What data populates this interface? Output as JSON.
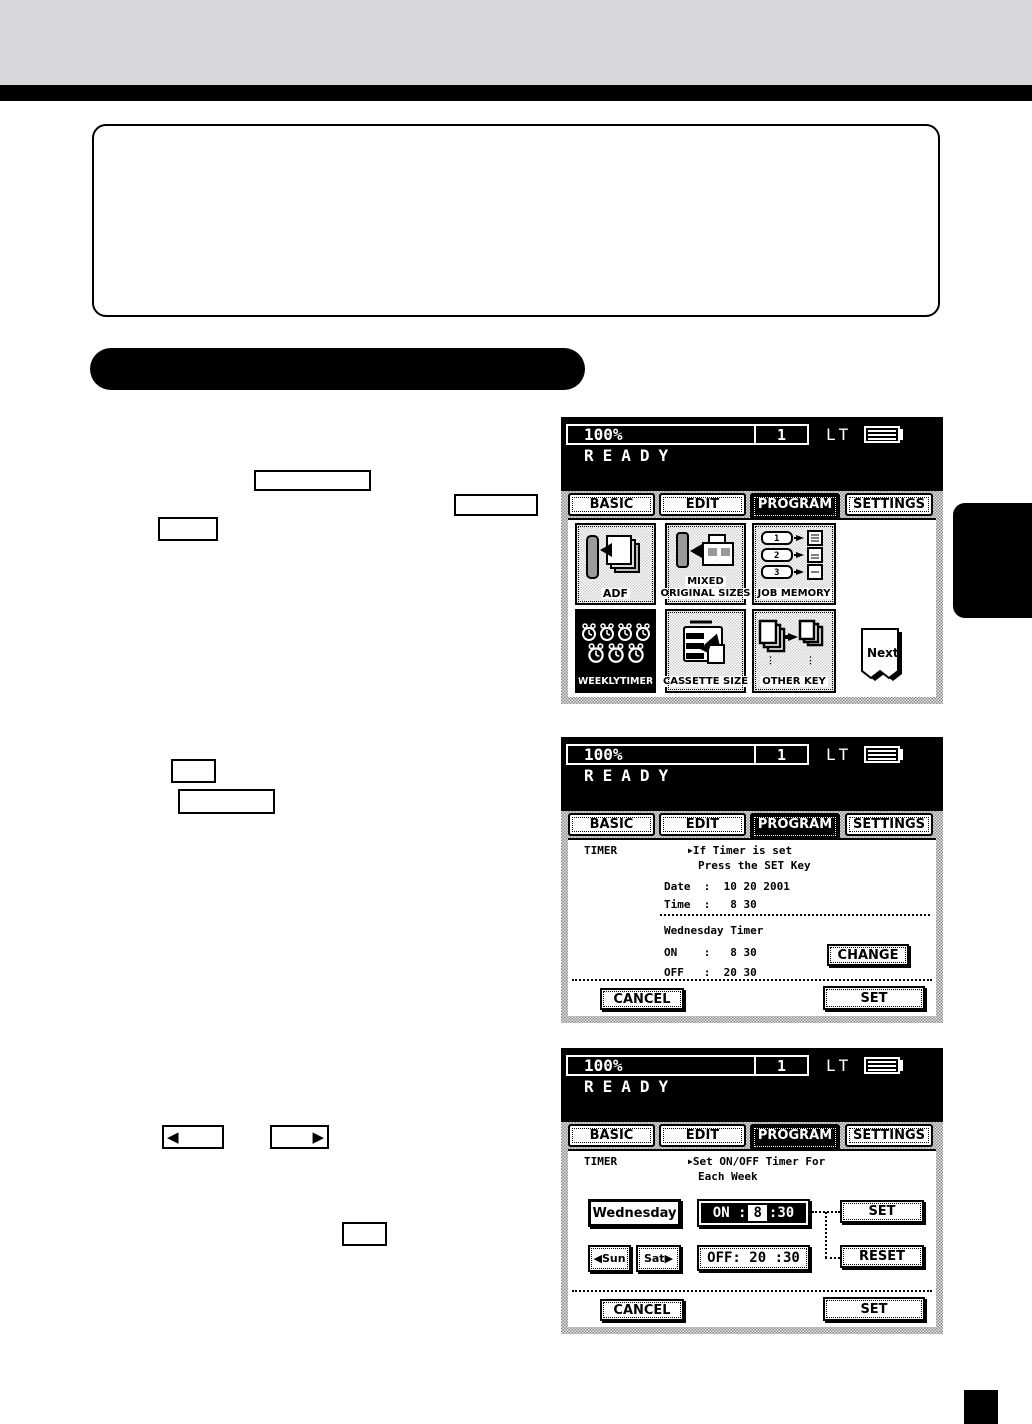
{
  "page": {
    "top_band_color": "#d5d7da",
    "accent_color": "#000000"
  },
  "panel_header": {
    "zoom": "100%",
    "copy_count": "1",
    "paper_size": "LT",
    "status": "READY"
  },
  "tabs": [
    {
      "label": "BASIC"
    },
    {
      "label": "EDIT"
    },
    {
      "label": "PROGRAM"
    },
    {
      "label": "SETTINGS"
    }
  ],
  "screen1": {
    "adf_label": "ADF",
    "mixed_line1": "MIXED",
    "mixed_line2": "ORIGINAL SIZES",
    "job_memory_label": "JOB MEMORY",
    "job_slots": [
      "1",
      "2",
      "3"
    ],
    "weekly_timer_label": "WEEKLYTIMER",
    "cassette_label": "CASSETTE SIZE",
    "other_key_label": "OTHER KEY",
    "next_label": "Next"
  },
  "screen2": {
    "timer_label": "TIMER",
    "marker": "▶",
    "prompt_line1": "If Timer is set",
    "prompt_line2": "Press the SET Key",
    "date_row": "Date  :  10 20 2001",
    "time_row": "Time  :   8 30",
    "week_title": "Wednesday Timer",
    "on_row": "ON    :   8 30",
    "off_row": "OFF   :  20 30",
    "change_label": "CHANGE",
    "cancel_label": "CANCEL",
    "set_label": "SET"
  },
  "screen3": {
    "timer_label": "TIMER",
    "marker": "▶",
    "prompt_line1": "Set ON/OFF Timer For",
    "prompt_line2": "Each Week",
    "day_label": "Wednesday",
    "on_label": "ON :",
    "on_hour": "8",
    "on_minute": ":30",
    "off_label": "OFF: 20 :30",
    "sun_arrow": "◀",
    "sun_label": "Sun",
    "sat_label": "Sat",
    "sat_arrow": "▶",
    "set_key_label": "SET",
    "reset_key_label": "RESET",
    "cancel_label": "CANCEL",
    "set_label": "SET"
  },
  "manual_keys": {
    "left_arrow": "◀",
    "right_arrow": "▶"
  }
}
